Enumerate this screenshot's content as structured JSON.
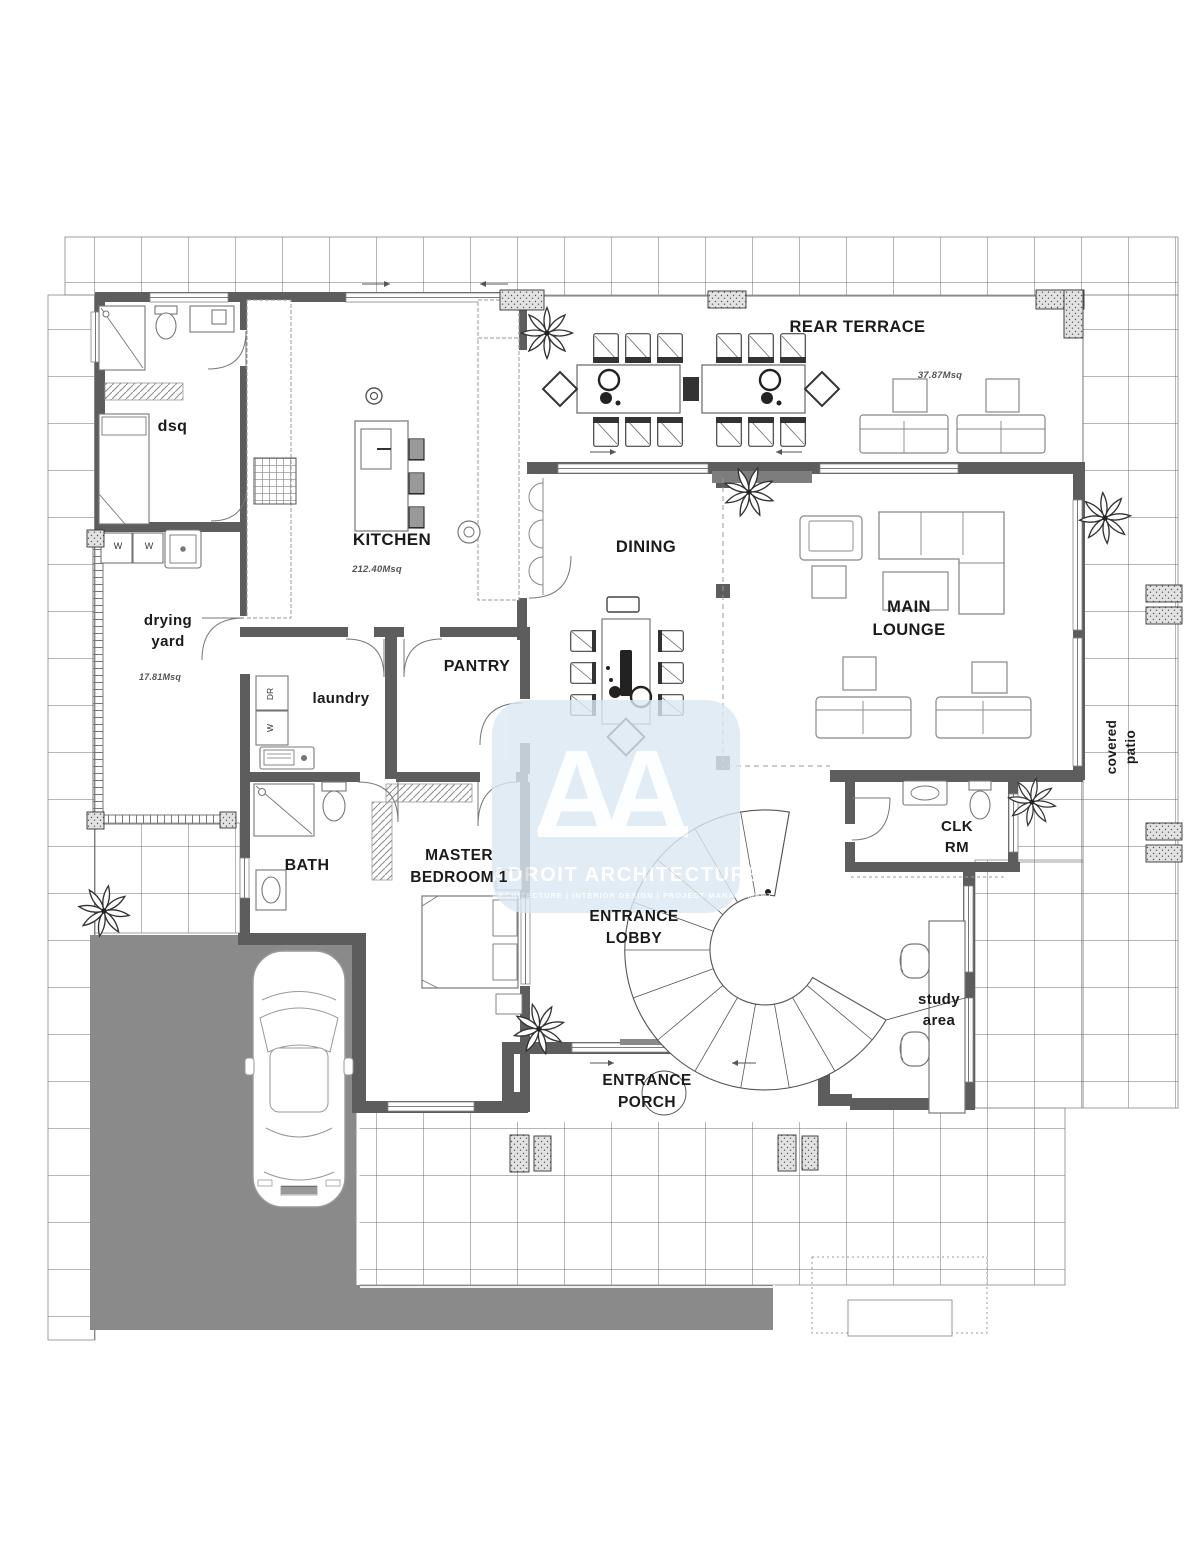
{
  "watermark": {
    "brand": "ADROIT ARCHITECTURE",
    "tagline": "ARCHITECTURE | INTERIOR DESIGN | PROJECT MANAGEMENT",
    "monogram_letter": "A"
  },
  "rooms": {
    "rear_terrace": {
      "label": "REAR TERRACE",
      "area": "37.87Msq"
    },
    "kitchen": {
      "label": "KITCHEN",
      "area": "212.40Msq"
    },
    "dining": {
      "label": "DINING"
    },
    "main_lounge": {
      "label": "MAIN\nLOUNGE"
    },
    "dsq": {
      "label": "dsq"
    },
    "drying_yard": {
      "label": "drying\nyard",
      "area": "17.81Msq"
    },
    "laundry": {
      "label": "laundry"
    },
    "pantry": {
      "label": "PANTRY"
    },
    "bath": {
      "label": "BATH"
    },
    "master_bedroom": {
      "label": "MASTER\nBEDROOM 1"
    },
    "entrance_lobby": {
      "label": "ENTRANCE\nLOBBY"
    },
    "entrance_porch": {
      "label": "ENTRANCE\nPORCH"
    },
    "clk_rm": {
      "label": "CLK\nRM"
    },
    "study_area": {
      "label": "study\narea"
    },
    "covered_patio": {
      "label": "covered\npatio"
    }
  },
  "appliances": {
    "dryer": "DR",
    "washer": "W",
    "yard_washer_1": "W",
    "yard_washer_2": "W"
  },
  "colors": {
    "wall": "#5d5d5d",
    "driveway": "#8a8a8a",
    "watermark_bg": "#dbe8f2",
    "grid_line": "#6f6f6f"
  }
}
